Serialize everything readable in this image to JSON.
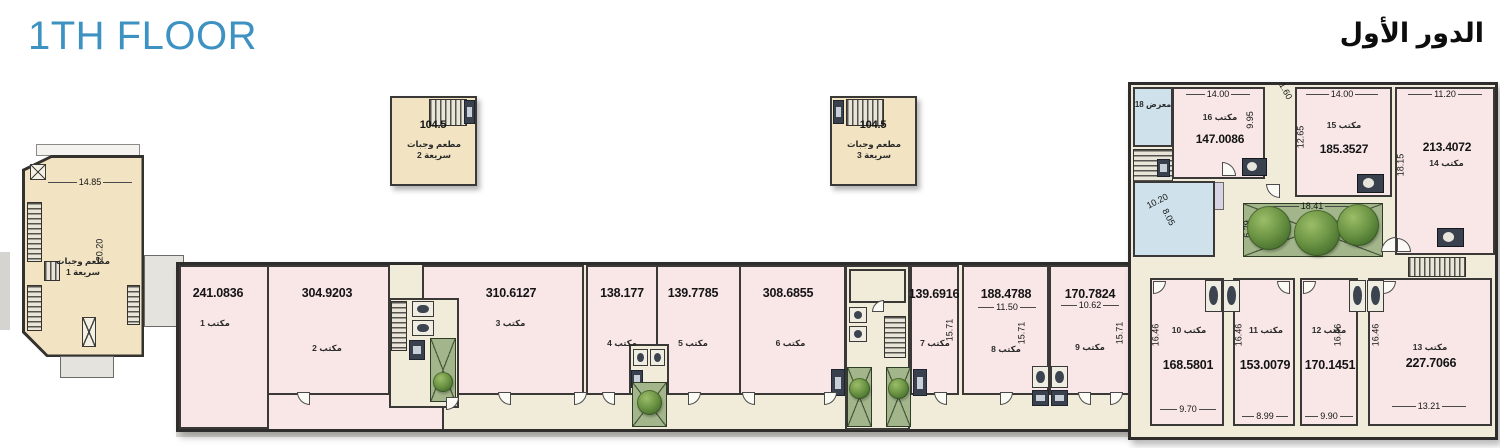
{
  "header": {
    "title_en": "1TH FLOOR",
    "title_ar": "الدور الأول"
  },
  "left_building": {
    "label": "مطعم وجبات سريعة 1",
    "width_dim": "14.85",
    "height_dim": "20.20"
  },
  "kiosks": [
    {
      "area": "104.5",
      "label": "مطعم وجبات سريعة 2"
    },
    {
      "area": "104.5",
      "label": "مطعم وجبات سريعة 3"
    }
  ],
  "offices": [
    {
      "label": "مكتب 1",
      "area": "241.0836"
    },
    {
      "label": "مكتب 2",
      "area": "304.9203"
    },
    {
      "label": "مكتب 3",
      "area": "310.6127"
    },
    {
      "label": "مكتب 4",
      "area": "138.177"
    },
    {
      "label": "مكتب 5",
      "area": "139.7785"
    },
    {
      "label": "مكتب 6",
      "area": "308.6855"
    },
    {
      "label": "مكتب 7",
      "area": "139.6916",
      "height_dim": "15.71"
    },
    {
      "label": "مكتب 8",
      "area": "188.4788",
      "width_dim": "11.50",
      "height_dim": "15.71"
    },
    {
      "label": "مكتب 9",
      "area": "170.7824",
      "width_dim": "10.62",
      "height_dim": "15.71"
    },
    {
      "label": "مكتب 10",
      "area": "168.5801",
      "width_dim": "9.70",
      "height_dim": "16.46"
    },
    {
      "label": "مكتب 11",
      "area": "153.0079",
      "width_dim": "8.99",
      "height_dim": "16.46"
    },
    {
      "label": "مكتب 12",
      "area": "170.1451",
      "width_dim": "9.90",
      "height_dim": "16.46"
    },
    {
      "label": "مكتب 13",
      "area": "227.7066",
      "width_dim": "13.21",
      "height_dim": "16.46"
    },
    {
      "label": "مكتب 14",
      "area": "213.4072",
      "width_dim": "11.20",
      "height_dim": "18.15"
    },
    {
      "label": "مكتب 15",
      "area": "185.3527",
      "width_dim": "14.00",
      "height_dim": "12.65"
    },
    {
      "label": "مكتب 16",
      "area": "147.0086",
      "width_dim": "14.00",
      "height_dim": "9.95"
    }
  ],
  "gallery": {
    "label": "معرض 18"
  },
  "courtyard": {
    "width_dim": "18.41",
    "height_dim": "6.29"
  },
  "atrium": {
    "dim_a": "10.20",
    "dim_b": "8.05"
  },
  "extra_dims": {
    "gap": "1.60"
  },
  "colors": {
    "accent": "#3e92c2",
    "room_pink": "#f9e7e7",
    "beige": "#f2e4c2",
    "blue": "#cfe2ec",
    "cream": "#f1ecda",
    "green": "#a2b58b",
    "wall": "#2e2d2b"
  }
}
